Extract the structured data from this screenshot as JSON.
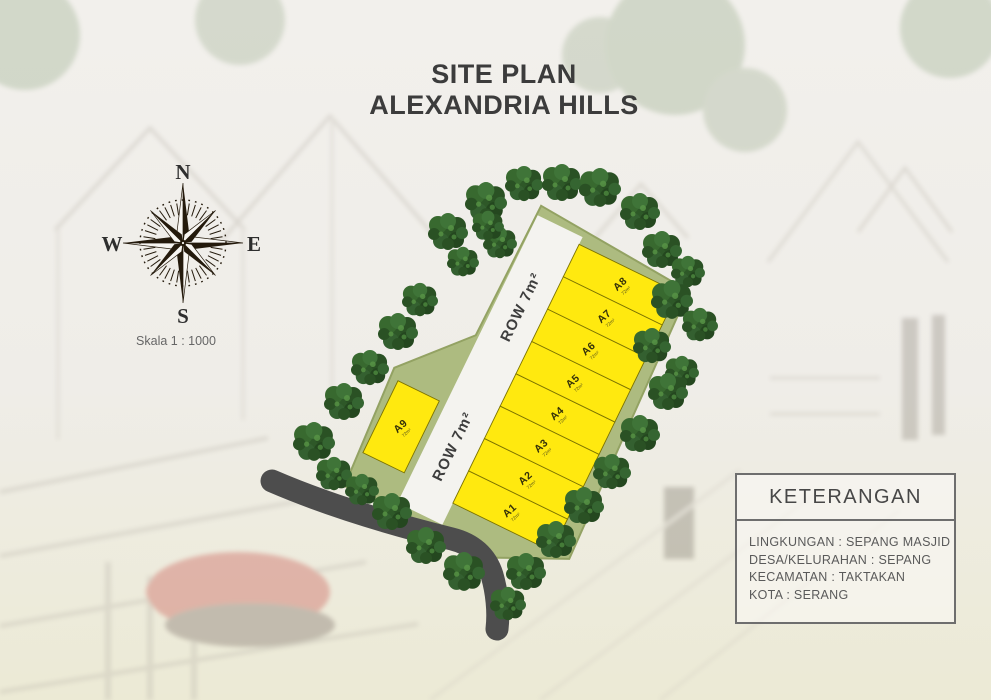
{
  "title": {
    "line1": "SITE PLAN",
    "line2": "ALEXANDRIA HILLS"
  },
  "compass": {
    "north": "N",
    "east": "E",
    "south": "S",
    "west": "W"
  },
  "scale_label": "Skala 1 : 1000",
  "site_plan": {
    "road_label": "ROW 7m²",
    "lots": [
      {
        "id": "A1",
        "area": "72m²"
      },
      {
        "id": "A2",
        "area": "72m²"
      },
      {
        "id": "A3",
        "area": "72m²"
      },
      {
        "id": "A4",
        "area": "72m²"
      },
      {
        "id": "A5",
        "area": "72m²"
      },
      {
        "id": "A6",
        "area": "72m²"
      },
      {
        "id": "A7",
        "area": "72m²"
      },
      {
        "id": "A8",
        "area": "72m²"
      },
      {
        "id": "A9",
        "area": "72m²"
      }
    ]
  },
  "legend": {
    "title": "KETERANGAN",
    "rows": [
      "LINGKUNGAN : SEPANG MASJID",
      "DESA/KELURAHAN : SEPANG",
      "KECAMATAN : TAKTAKAN",
      "KOTA : SERANG"
    ]
  },
  "colors": {
    "lot_fill": "#ffe90f",
    "lot_border": "#7c7300",
    "parcel_green": "#adbb80",
    "internal_road": "#f4f3ef",
    "access_road": "#4d4d4d",
    "tree_green": "#2e5828",
    "title_text": "#3c3c3c"
  }
}
